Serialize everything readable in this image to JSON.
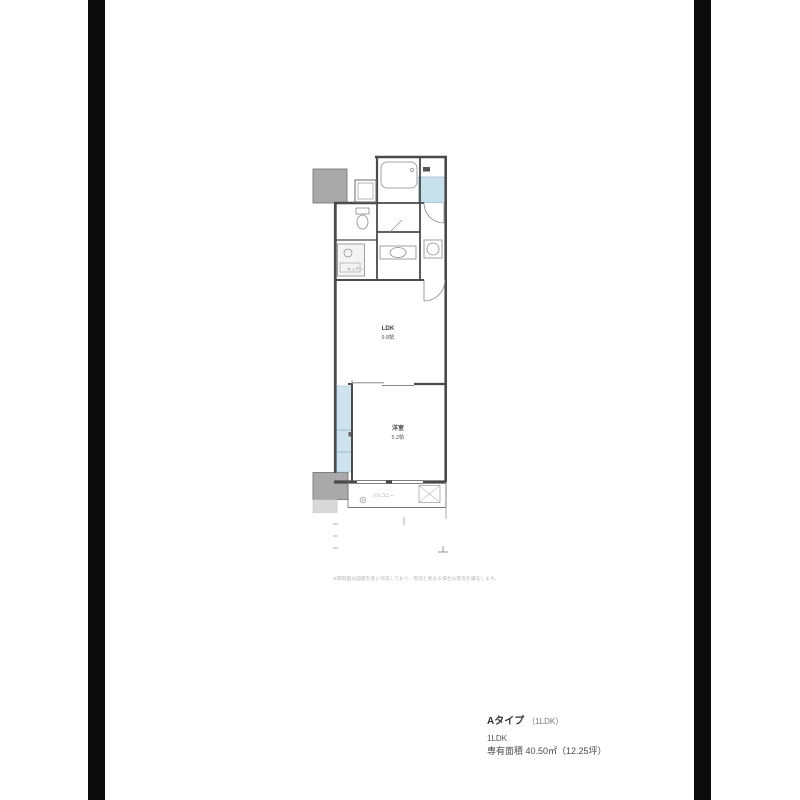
{
  "page": {
    "background": "#ffffff",
    "side_band_color": "#0b0b0b"
  },
  "floor_plan": {
    "colors": {
      "wall": "#4a4a4a",
      "pillar": "#a9a9a9",
      "highlight_blue": "#c8dfec",
      "closet_blue": "#cfe3ee",
      "fixture_line": "#8a8a8a"
    },
    "labels": {
      "ldk_name": "LDK",
      "ldk_size": "9.8帖",
      "bedroom_name": "洋室",
      "bedroom_size": "5.2帖",
      "kitchen": "キッチン",
      "balcony": "バルコニー"
    },
    "disclaimer": "※間取図は図面を基に作成しており、現況と異なる場合は現況を優先します。"
  },
  "info_block": {
    "plan_name": "Aタイプ",
    "plan_name_note": "（1LDK）",
    "layout": "1LDK",
    "area": "専有面積 40.50㎡（12.25坪）"
  }
}
